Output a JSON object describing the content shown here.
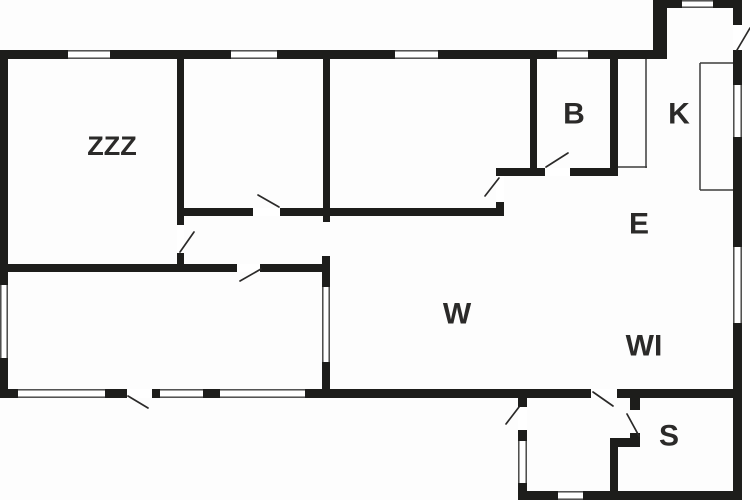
{
  "canvas": {
    "width": 750,
    "height": 500,
    "background": "#fdfdfd",
    "wall_color": "#1d1d1b",
    "swing_color": "#2b2a29",
    "thin_color": "#3c3c3b",
    "window_fill": "#ffffff",
    "label_color": "#2b2a29"
  },
  "rooms": [
    {
      "id": "zzz",
      "label": "ZZZ",
      "cx": 112,
      "cy": 146,
      "size": 27
    },
    {
      "id": "b",
      "label": "B",
      "cx": 574,
      "cy": 114,
      "size": 30
    },
    {
      "id": "k",
      "label": "K",
      "cx": 679,
      "cy": 114,
      "size": 30
    },
    {
      "id": "e",
      "label": "E",
      "cx": 639,
      "cy": 224,
      "size": 30
    },
    {
      "id": "w",
      "label": "W",
      "cx": 457,
      "cy": 314,
      "size": 30
    },
    {
      "id": "wi",
      "label": "WI",
      "cx": 644,
      "cy": 346,
      "size": 30
    },
    {
      "id": "s",
      "label": "S",
      "cx": 669,
      "cy": 436,
      "size": 30
    }
  ],
  "walls": [
    {
      "name": "top-wall",
      "x": 0,
      "y": 50,
      "w": 667,
      "h": 9
    },
    {
      "name": "bump-left-wall",
      "x": 653,
      "y": 0,
      "w": 14,
      "h": 59
    },
    {
      "name": "bump-top-wall",
      "x": 653,
      "y": 0,
      "w": 89,
      "h": 8
    },
    {
      "name": "right-wall",
      "x": 733,
      "y": 0,
      "w": 9,
      "h": 500
    },
    {
      "name": "left-wall",
      "x": 0,
      "y": 50,
      "w": 8,
      "h": 348
    },
    {
      "name": "bottom-wall",
      "x": 0,
      "y": 389,
      "w": 742,
      "h": 9
    },
    {
      "name": "annex-left-wall",
      "x": 518,
      "y": 389,
      "w": 9,
      "h": 111
    },
    {
      "name": "annex-bottom-wall",
      "x": 518,
      "y": 491,
      "w": 224,
      "h": 9
    },
    {
      "name": "bed1-right-wall",
      "x": 177,
      "y": 50,
      "w": 7,
      "h": 175
    },
    {
      "name": "bed1-right-stub",
      "x": 177,
      "y": 253,
      "w": 7,
      "h": 19
    },
    {
      "name": "bed2-right-wall",
      "x": 323,
      "y": 50,
      "w": 7,
      "h": 172
    },
    {
      "name": "hall-top-wall",
      "x": 177,
      "y": 208,
      "w": 327,
      "h": 8
    },
    {
      "name": "hall-jog-wall",
      "x": 496,
      "y": 168,
      "w": 8,
      "h": 48
    },
    {
      "name": "bath-bottom-wall",
      "x": 496,
      "y": 168,
      "w": 122,
      "h": 8
    },
    {
      "name": "bath-left-wall",
      "x": 530,
      "y": 50,
      "w": 7,
      "h": 118
    },
    {
      "name": "bath-right-wall",
      "x": 610,
      "y": 50,
      "w": 8,
      "h": 126
    },
    {
      "name": "bed3-top-wall",
      "x": 0,
      "y": 264,
      "w": 330,
      "h": 8
    },
    {
      "name": "bed3-right-wall",
      "x": 322,
      "y": 256,
      "w": 8,
      "h": 133
    },
    {
      "name": "s-left-wall-upper",
      "x": 630,
      "y": 389,
      "w": 10,
      "h": 58
    },
    {
      "name": "s-step-wall",
      "x": 610,
      "y": 438,
      "w": 30,
      "h": 9
    },
    {
      "name": "s-left-wall-lower",
      "x": 610,
      "y": 438,
      "w": 8,
      "h": 62
    }
  ],
  "door_gaps": [
    {
      "name": "bed1-door-gap",
      "x": 177,
      "y": 225,
      "w": 7,
      "h": 28
    },
    {
      "name": "bed2-door-gap",
      "x": 253,
      "y": 208,
      "w": 27,
      "h": 8
    },
    {
      "name": "bed3-door-gap",
      "x": 237,
      "y": 264,
      "w": 23,
      "h": 8
    },
    {
      "name": "w-door-gap",
      "x": 496,
      "y": 176,
      "w": 8,
      "h": 26
    },
    {
      "name": "bath-door-gap",
      "x": 545,
      "y": 168,
      "w": 25,
      "h": 8
    },
    {
      "name": "entry-door-gap",
      "x": 733,
      "y": 25,
      "w": 9,
      "h": 25
    },
    {
      "name": "hall-door-gap",
      "x": 591,
      "y": 389,
      "w": 26,
      "h": 9
    },
    {
      "name": "annex-entry-door-gap",
      "x": 518,
      "y": 407,
      "w": 9,
      "h": 23
    },
    {
      "name": "s-door-gap",
      "x": 630,
      "y": 410,
      "w": 10,
      "h": 23
    },
    {
      "name": "main-entry-door-gap",
      "x": 127,
      "y": 389,
      "w": 25,
      "h": 9
    }
  ],
  "windows": [
    {
      "name": "window-top-1",
      "x": 68,
      "y": 50,
      "w": 42,
      "h": 9,
      "orient": "h"
    },
    {
      "name": "window-top-2",
      "x": 231,
      "y": 50,
      "w": 46,
      "h": 9,
      "orient": "h"
    },
    {
      "name": "window-top-3",
      "x": 395,
      "y": 50,
      "w": 43,
      "h": 9,
      "orient": "h"
    },
    {
      "name": "window-top-4",
      "x": 557,
      "y": 50,
      "w": 31,
      "h": 9,
      "orient": "h"
    },
    {
      "name": "window-bump-top",
      "x": 682,
      "y": 0,
      "w": 31,
      "h": 8,
      "orient": "h"
    },
    {
      "name": "window-left",
      "x": 0,
      "y": 285,
      "w": 8,
      "h": 73,
      "orient": "v"
    },
    {
      "name": "window-right-1",
      "x": 733,
      "y": 85,
      "w": 9,
      "h": 52,
      "orient": "v"
    },
    {
      "name": "window-right-2",
      "x": 733,
      "y": 247,
      "w": 9,
      "h": 76,
      "orient": "v"
    },
    {
      "name": "window-bottom-1",
      "x": 18,
      "y": 389,
      "w": 87,
      "h": 9,
      "orient": "h"
    },
    {
      "name": "window-bottom-2",
      "x": 160,
      "y": 389,
      "w": 43,
      "h": 9,
      "orient": "h"
    },
    {
      "name": "window-bottom-3",
      "x": 220,
      "y": 389,
      "w": 85,
      "h": 9,
      "orient": "h"
    },
    {
      "name": "window-annex-left",
      "x": 518,
      "y": 441,
      "w": 9,
      "h": 42,
      "orient": "v"
    },
    {
      "name": "window-annex-bottom",
      "x": 558,
      "y": 491,
      "w": 25,
      "h": 9,
      "orient": "h"
    },
    {
      "name": "window-bed3-right",
      "x": 322,
      "y": 287,
      "w": 8,
      "h": 75,
      "orient": "v"
    }
  ],
  "door_swings": [
    {
      "name": "bed1-door-swing",
      "x1": 180,
      "y1": 252,
      "x2": 194,
      "y2": 232
    },
    {
      "name": "bed2-door-swing",
      "x1": 279,
      "y1": 207,
      "x2": 258,
      "y2": 195
    },
    {
      "name": "bed3-door-swing",
      "x1": 240,
      "y1": 281,
      "x2": 261,
      "y2": 269
    },
    {
      "name": "w-door-swing",
      "x1": 485,
      "y1": 196,
      "x2": 499,
      "y2": 178
    },
    {
      "name": "bath-door-swing",
      "x1": 546,
      "y1": 167,
      "x2": 568,
      "y2": 153
    },
    {
      "name": "entry-door-swing",
      "x1": 737,
      "y1": 50,
      "x2": 750,
      "y2": 28
    },
    {
      "name": "hall-door-swing",
      "x1": 593,
      "y1": 392,
      "x2": 613,
      "y2": 406
    },
    {
      "name": "annex-entry-door-swing",
      "x1": 506,
      "y1": 424,
      "x2": 519,
      "y2": 407
    },
    {
      "name": "s-door-swing",
      "x1": 627,
      "y1": 414,
      "x2": 639,
      "y2": 436
    },
    {
      "name": "main-entry-door-swing",
      "x1": 128,
      "y1": 396,
      "x2": 148,
      "y2": 408
    }
  ],
  "thin_lines": [
    {
      "name": "closet-right-edge",
      "x1": 646,
      "y1": 59,
      "x2": 646,
      "y2": 168
    },
    {
      "name": "closet-bottom-edge",
      "x1": 618,
      "y1": 167,
      "x2": 647,
      "y2": 167
    },
    {
      "name": "counter-left-edge",
      "x1": 700,
      "y1": 63,
      "x2": 700,
      "y2": 190
    },
    {
      "name": "counter-top-edge",
      "x1": 700,
      "y1": 63,
      "x2": 733,
      "y2": 63
    },
    {
      "name": "counter-bottom-edge",
      "x1": 700,
      "y1": 190,
      "x2": 733,
      "y2": 190
    }
  ]
}
